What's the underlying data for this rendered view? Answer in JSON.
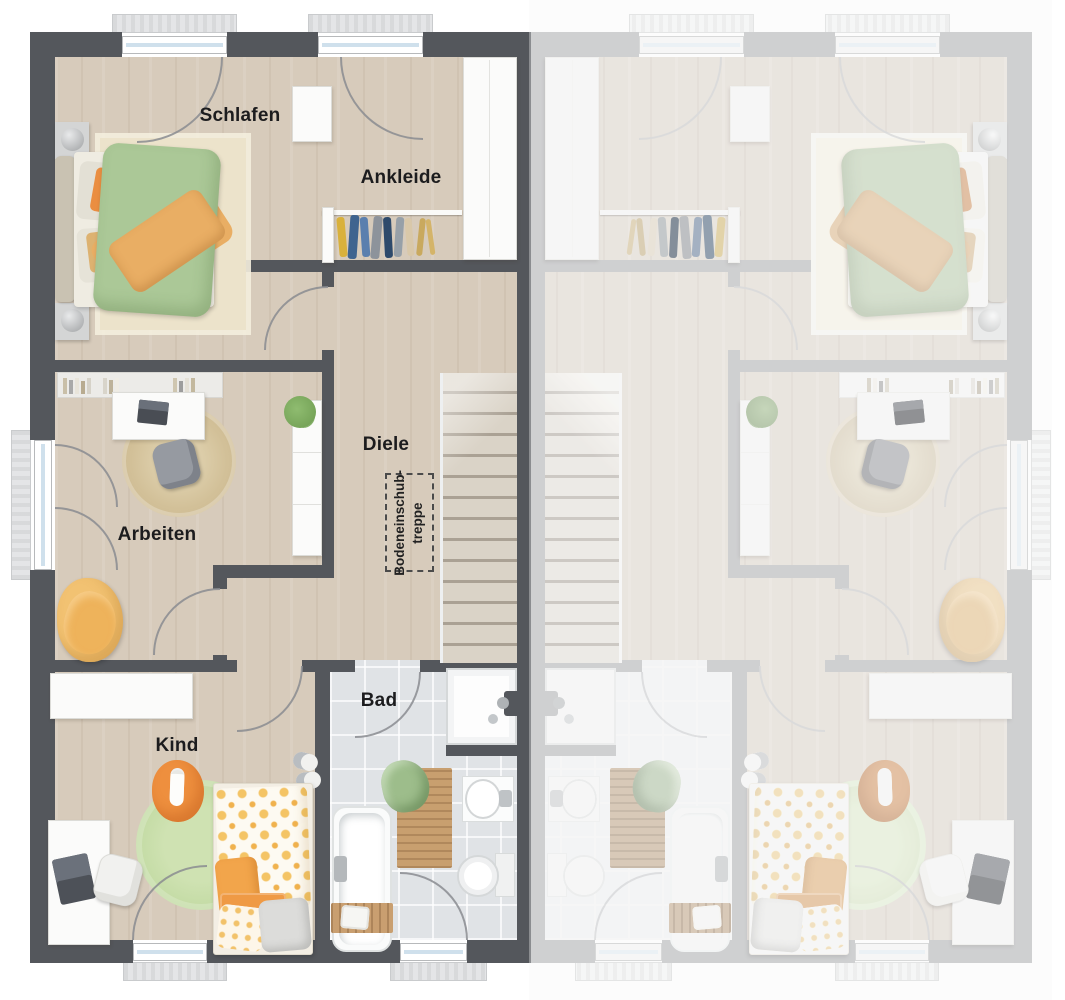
{
  "floorplan": {
    "rooms": {
      "schlafen": "Schlafen",
      "ankleide": "Ankleide",
      "diele": "Diele",
      "arbeiten": "Arbeiten",
      "kind": "Kind",
      "bad": "Bad"
    },
    "annotations": {
      "attic_stairs": "Bodeneinschub-\ntreppe"
    },
    "colors": {
      "active_wall": "#54575c",
      "inactive_wall": "#aaacaf",
      "wood_floor": "#d7cbbb",
      "tile_floor": "#e0e3e6",
      "accent_green": "#abc897",
      "accent_orange": "#e9a055"
    }
  }
}
